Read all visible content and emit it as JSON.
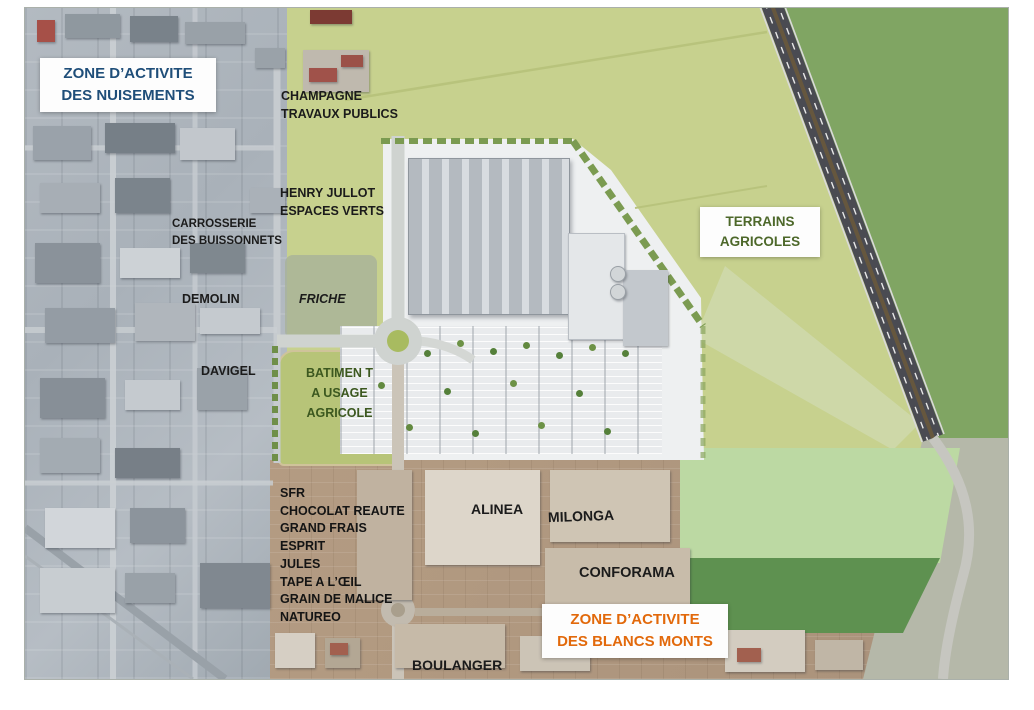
{
  "page": {
    "type": "aerial-development-site-map"
  },
  "zones": {
    "nuisements": {
      "line1": "ZONE D’ACTIVITE",
      "line2": "DES NUISEMENTS",
      "text_color": "#1f4e79"
    },
    "terrains_agricoles": {
      "line1": "TERRAINS",
      "line2": "AGRICOLES",
      "text_color": "#4d682a"
    },
    "blancs_monts": {
      "line1": "ZONE D’ACTIVITE",
      "line2": "DES BLANCS MONTS",
      "text_color": "#e2690b"
    }
  },
  "places": {
    "champagne": {
      "line1": "CHAMPAGNE",
      "line2": "TRAVAUX PUBLICS"
    },
    "henry_jullot": {
      "line1": "HENRY JULLOT",
      "line2": "ESPACES VERTS"
    },
    "carrosserie": {
      "line1": "CARROSSERIE",
      "line2": "DES BUISSONNETS"
    },
    "demolin": "DEMOLIN",
    "friche": "FRICHE",
    "davigel": "DAVIGEL",
    "batiment_agricole": {
      "line1": "BATIMEN T",
      "line2": "A USAGE",
      "line3": "AGRICOLE",
      "text_color": "#3c581f"
    },
    "alinea": "ALINEA",
    "milonga": "MILONGA",
    "conforama": "CONFORAMA",
    "boulanger": "BOULANGER"
  },
  "blancs_monts_stores": [
    "SFR",
    "CHOCOLAT REAUTE",
    "GRAND FRAIS",
    "ESPRIT",
    "JULES",
    "TAPE A L’ŒIL",
    "GRAIN DE MALICE",
    "NATUREO"
  ]
}
